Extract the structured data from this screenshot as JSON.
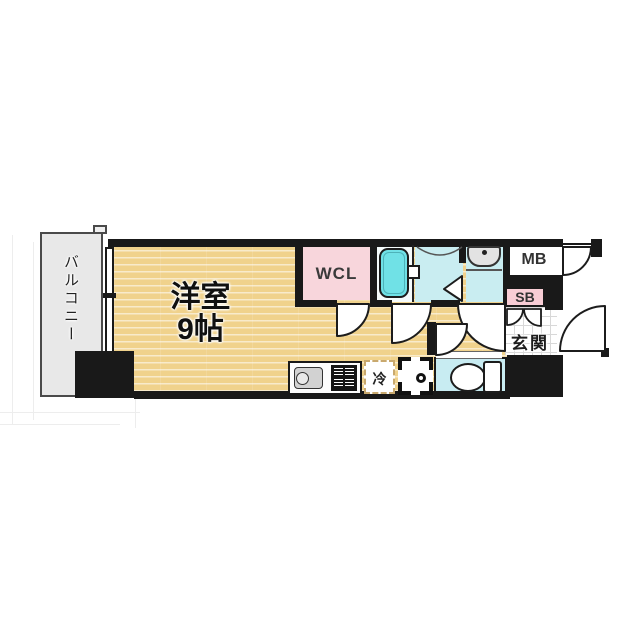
{
  "floorplan": {
    "labels": {
      "balcony": "バルコニー",
      "main_room_line1": "洋室",
      "main_room_line2": "9帖",
      "walk_in_closet": "WCL",
      "meter_box": "MB",
      "shoe_box": "SB",
      "entrance": "玄関",
      "refrigerator": "冷"
    },
    "colors": {
      "wood_floor": "#f0d28c",
      "wcl_pink": "#f8d6dc",
      "shoe_box_pink": "#f8cdd5",
      "bathtub_cyan": "#70e1e6",
      "wet_area_cyan": "#c9edf1",
      "wall_black": "#191919",
      "balcony_gray": "#e8e8e8"
    }
  }
}
